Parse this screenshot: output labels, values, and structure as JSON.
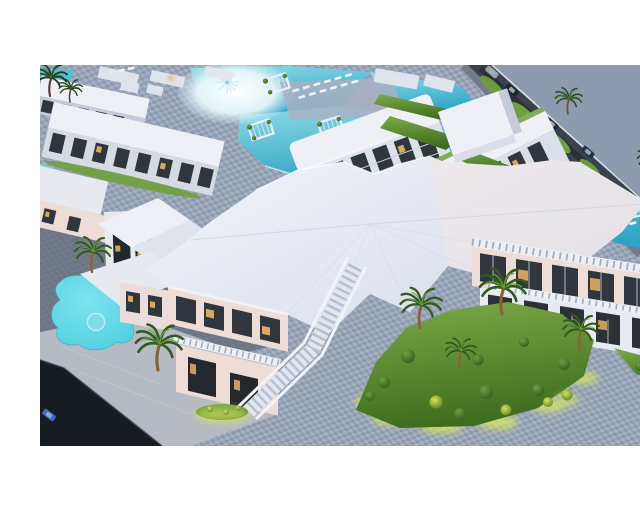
{
  "meta": {
    "content_type": "3d-architectural-render",
    "description": "Aerial dusk 3D rendering of a white seaside resort: apartment blocks and villas around turquoise pools, a large faceted white clubhouse roof in the center with a grand outdoor staircase, glass facades with warm lit windows, cobblestone plazas, landscaped palm-garden islands with yellow uplighting, a freeform lagoon pool with round spa at the lower left, a perimeter road with cars at the top right, and a dark access road with a blue car at the bottom left. Image is letterboxed with white bars top and bottom.",
    "canvas": {
      "width": 640,
      "height": 480
    },
    "image_area": {
      "top": 49,
      "bottom": 430
    }
  },
  "palette": {
    "letterbox": "#ffffff",
    "slate_flat": "#8e9ab0",
    "cobble_base": "#97a3b6",
    "cobble_light": "#b3bdcd",
    "cobble_dark": "#7e8ba0",
    "plaza_light": "#b6bac2",
    "stone_dark": "#5f6673",
    "road_dark": "#171c22",
    "asphalt": "#39424e",
    "building_white": "#e7e9ee",
    "building_shadow": "#c5cbd8",
    "building_pink": "#eedcd6",
    "roof_white": "#eef0f6",
    "window_dark": "#30363d",
    "window_warm": "#d9a95f",
    "pool_light": "#8fdce8",
    "pool_mid": "#52c0d6",
    "pool_deep": "#2ea4c4",
    "lagoon": "#4ecede",
    "green_bright": "#6fa03c",
    "green_dark": "#2f5a20",
    "glow_yellow": "#dcea5e",
    "trunk_brown": "#8a6239",
    "car_blue": "#3a6bc8"
  },
  "scene": {
    "regions": [
      {
        "name": "apartment-blocks",
        "label": "white apartment blocks with dark window bays and balconies"
      },
      {
        "name": "pool-complex",
        "label": "turquoise swimming pools with white beach entry, pergola cabanas and sun loungers"
      },
      {
        "name": "perimeter-road",
        "label": "diagonal perimeter road with cars and roadside palms, flat slate ground beyond"
      },
      {
        "name": "clubhouse",
        "label": "central clubhouse with faceted white roof, glass storefronts and grand staircase"
      },
      {
        "name": "right-wing",
        "label": "two-storey glass facade wing shaded by pergolas"
      },
      {
        "name": "palm-garden",
        "label": "landscaped island with palms, round shrubs and yellow uplighting"
      },
      {
        "name": "lagoon-pool",
        "label": "freeform lagoon pool with round spa"
      },
      {
        "name": "plaza",
        "label": "cobblestone and light marble plazas"
      },
      {
        "name": "access-road",
        "label": "dark asphalt road with a blue car at the bottom left"
      }
    ],
    "counts": {
      "palm_trees": 12,
      "pergola_cabanas": 5,
      "cars": 4,
      "pools": 4,
      "garden_bushes": 15
    }
  }
}
